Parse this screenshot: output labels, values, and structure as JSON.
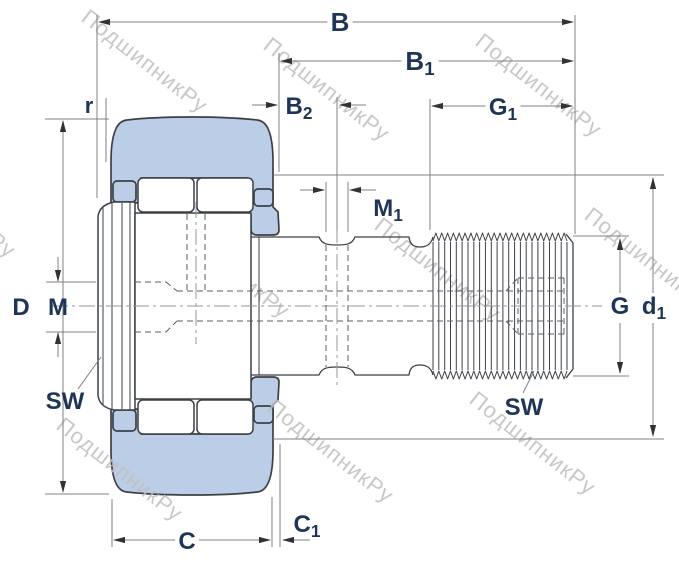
{
  "watermark": {
    "text": "ПодшипникРу",
    "color": "#bfbfbf",
    "angle_deg": 38,
    "positions": [
      {
        "x": 80,
        "y": 20
      },
      {
        "x": 262,
        "y": 48
      },
      {
        "x": 474,
        "y": 44
      },
      {
        "x": 583,
        "y": 218
      },
      {
        "x": -112,
        "y": 165
      },
      {
        "x": 162,
        "y": 225
      },
      {
        "x": 373,
        "y": 228
      },
      {
        "x": 55,
        "y": 428
      },
      {
        "x": 266,
        "y": 410
      },
      {
        "x": 468,
        "y": 402
      }
    ]
  },
  "dimension_labels": [
    {
      "id": "B",
      "text": "B",
      "sub": "",
      "x": 340,
      "y": 31,
      "size": 26,
      "gap": true
    },
    {
      "id": "B1",
      "text": "B",
      "sub": "1",
      "x": 420,
      "y": 70,
      "size": 26,
      "gap": true
    },
    {
      "id": "B2",
      "text": "B",
      "sub": "2",
      "x": 299,
      "y": 114,
      "size": 24,
      "gap": false
    },
    {
      "id": "G1",
      "text": "G",
      "sub": "1",
      "x": 503,
      "y": 115,
      "size": 24,
      "gap": true
    },
    {
      "id": "M1",
      "text": "M",
      "sub": "1",
      "x": 388,
      "y": 216,
      "size": 24,
      "gap": false
    },
    {
      "id": "r",
      "text": "r",
      "sub": "",
      "x": 89,
      "y": 113,
      "size": 22,
      "gap": false
    },
    {
      "id": "D",
      "text": "D",
      "sub": "",
      "x": 21,
      "y": 315,
      "size": 24,
      "gap": false
    },
    {
      "id": "M",
      "text": "M",
      "sub": "",
      "x": 58,
      "y": 315,
      "size": 24,
      "gap": false
    },
    {
      "id": "SW-left",
      "text": "SW",
      "sub": "",
      "x": 65,
      "y": 409,
      "size": 24,
      "gap": false
    },
    {
      "id": "C",
      "text": "C",
      "sub": "",
      "x": 187,
      "y": 549,
      "size": 24,
      "gap": true
    },
    {
      "id": "C1",
      "text": "C",
      "sub": "1",
      "x": 307,
      "y": 532,
      "size": 24,
      "gap": false
    },
    {
      "id": "G",
      "text": "G",
      "sub": "",
      "x": 620,
      "y": 314,
      "size": 24,
      "gap": true
    },
    {
      "id": "d1",
      "text": "d",
      "sub": "1",
      "x": 654,
      "y": 314,
      "size": 24,
      "gap": true
    },
    {
      "id": "SW-right",
      "text": "SW",
      "sub": "",
      "x": 524,
      "y": 415,
      "size": 24,
      "gap": false
    }
  ],
  "colors": {
    "outer_ring_fill": "#bccde8",
    "part_outline": "#3b4046",
    "dimension_line": "#7d8084",
    "label_text": "#1f3557",
    "watermark_text": "#bfbfbf"
  }
}
